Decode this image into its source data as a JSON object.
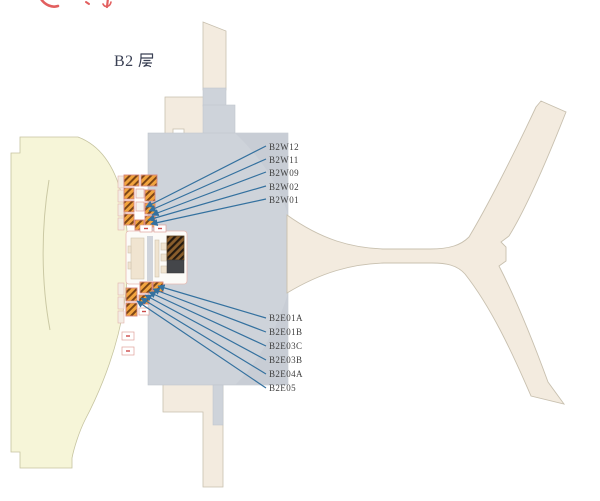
{
  "floor_title": {
    "text": "B2层",
    "prefix": "B2"
  },
  "labels": {
    "west": [
      "B2W12",
      "B2W11",
      "B2W09",
      "B2W02",
      "B2W01"
    ],
    "east": [
      "B2E01A",
      "B2E01B",
      "B2E03C",
      "B2E03B",
      "B2E04A",
      "B2E05"
    ]
  },
  "colors": {
    "background": "#ffffff",
    "gtc_fill": "#f6f5d8",
    "building_beige": "#f3ebdf",
    "terminal_gray": "#ced3da",
    "terminal_gray_shade": "#c8cdd5",
    "leader_line_blue": "#34719f",
    "label_text": "#3f3f3f",
    "title_text": "#3a4054",
    "hatch_orange": "#f2a43e",
    "hatch_stripe_brown": "#7c4515",
    "dark_hatch_brown": "#8a5e2c",
    "dark_shaft_gray": "#44464a",
    "pink_outline": "#e0a19a",
    "red_mark": "#cc4b4b",
    "clipped_red_marks": "#e25f5f"
  }
}
